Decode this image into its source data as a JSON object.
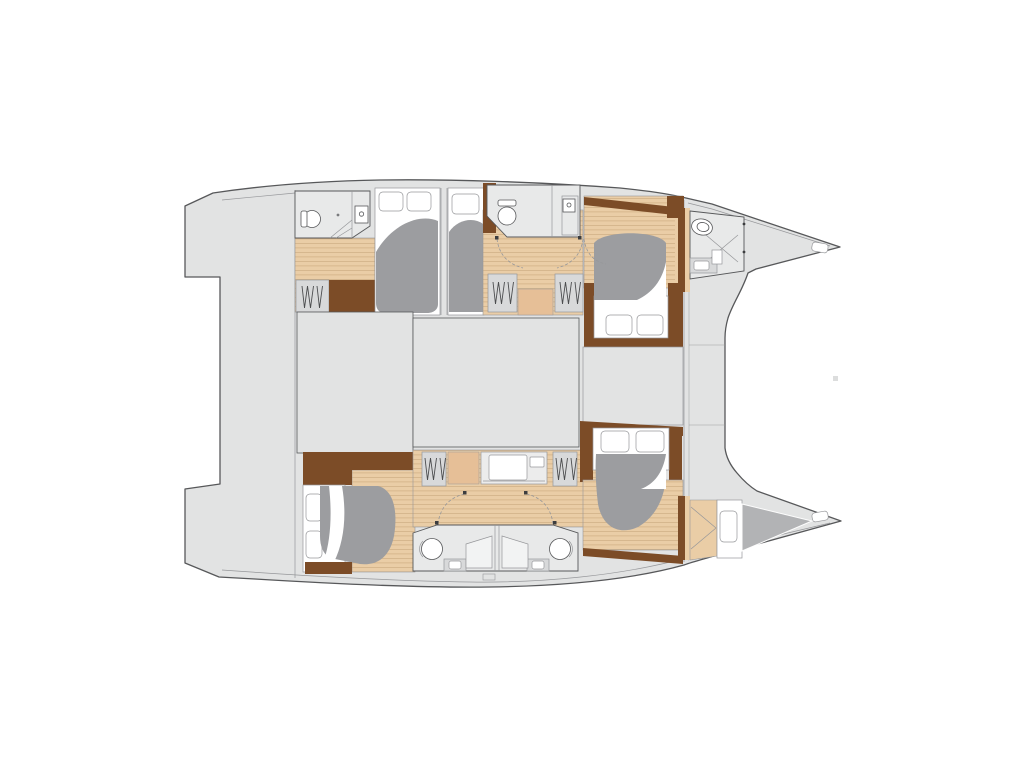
{
  "title": "",
  "diagram": {
    "kind": "catamaran-floor-plan-top-view",
    "regions": {
      "port_hull": [
        "aft-head",
        "aft-double-berth",
        "guest-berth",
        "mid-head",
        "companionway-wardrobes",
        "forward-double-berth",
        "bow-head"
      ],
      "bridge_deck": [
        "aft-deck",
        "saloon-panel-left",
        "saloon-panel-center",
        "forward-panel",
        "foredeck"
      ],
      "starboard_hull": [
        "aft-double-berth",
        "dressing-desk",
        "twin-heads",
        "forward-double-berth",
        "bow-berth"
      ]
    },
    "depicted_counts": {
      "double-berths": 5,
      "bow-berth-cushions": 1,
      "toilets": 5,
      "showers": 4,
      "sinks": 3,
      "wardrobes": 5,
      "hull-windows": 3,
      "pillows": 8
    }
  },
  "palette": {
    "bg": "#ffffff",
    "deck": "#e2e3e3",
    "room": "#e8e9e9",
    "panel": "#d8d9da",
    "line": "#57585a",
    "lineLight": "#96979a",
    "bed": "#9c9da0",
    "cushion": "#b2b3b5",
    "wood": "#eacda6",
    "woodStripe": "#cfae83",
    "woodDark": "#7c4c27",
    "peach": "#e6bf97"
  }
}
